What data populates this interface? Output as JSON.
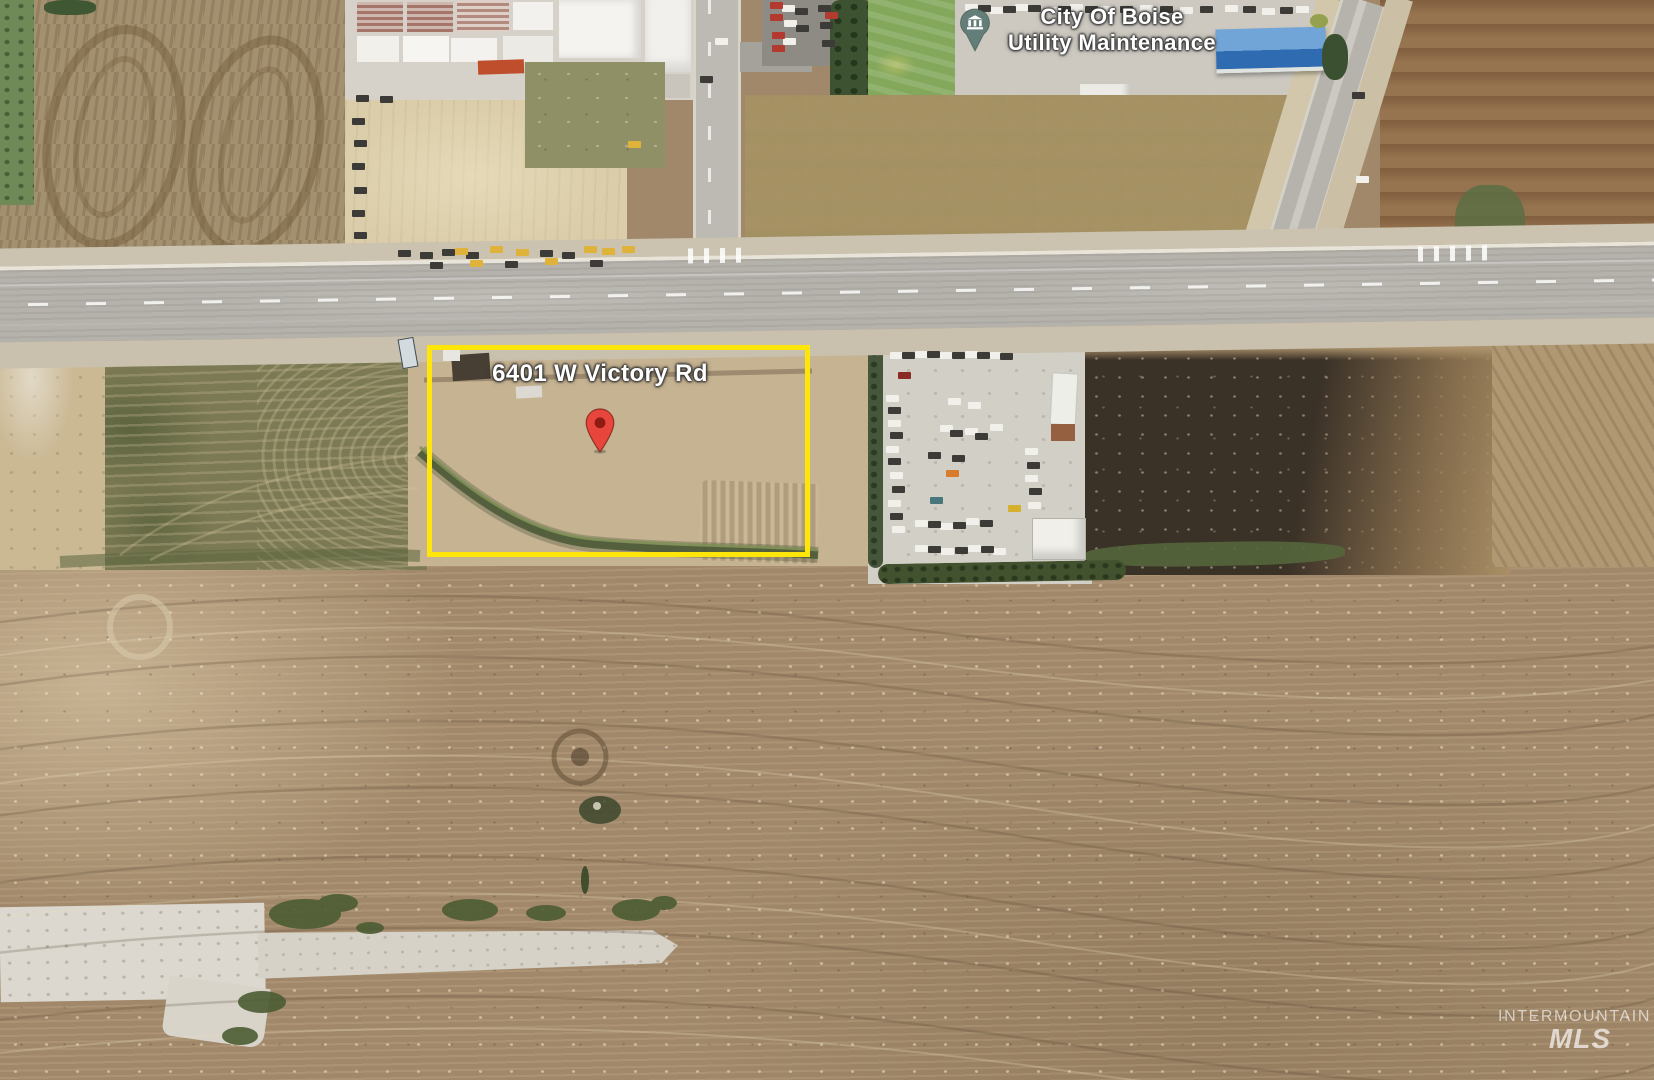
{
  "map_labels": {
    "poi": {
      "line1": "City Of Boise",
      "line2": "Utility Maintenance"
    },
    "address": "6401 W Victory Rd"
  },
  "markers": {
    "address_pin": {
      "icon": "location-pin-icon",
      "color": "#E8463C"
    },
    "poi_pin": {
      "icon": "government-building-pin-icon",
      "color": "#5E7A75"
    }
  },
  "property_highlight": {
    "shape": "rectangle",
    "color": "#FFE60A"
  },
  "watermark": {
    "line1": "INTERMOUNTAIN",
    "line2": "MLS"
  },
  "colors": {
    "highlight": "#FFE60A",
    "pin-red": "#E8463C",
    "pin-red-core": "#8E1B12",
    "poi-pin": "#5E7A75",
    "label-text": "#FFFFFF"
  }
}
